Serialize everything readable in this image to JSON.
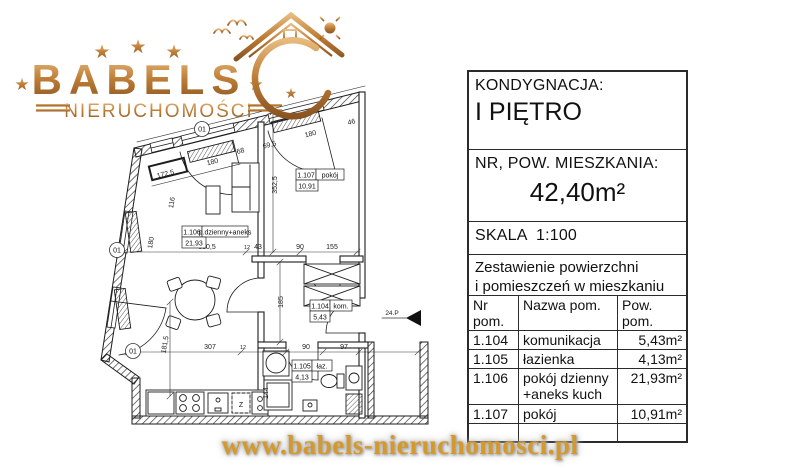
{
  "logo": {
    "brand": "BABELS",
    "subtitle": "NIERUCHOMOŚCI",
    "star": "★",
    "copper": "#b5762f"
  },
  "panel": {
    "floor_label": "KONDYGNACJA:",
    "floor_value": "I PIĘTRO",
    "area_label": "NR, POW. MIESZKANIA:",
    "area_value": "42,40m²",
    "scale_label": "SKALA  1:100",
    "table_title_line1": "Zestawienie powierzchni",
    "table_title_line2": "i pomieszczeń w mieszkaniu",
    "table": {
      "headers": [
        "Nr pom.",
        "Nazwa pom.",
        "Pow. pom."
      ],
      "rows": [
        {
          "nr": "1.104",
          "name": "komunikacja",
          "area": "5,43m²"
        },
        {
          "nr": "1.105",
          "name": "łazienka",
          "area": "4,13m²"
        },
        {
          "nr": "1.106",
          "name": "pokój dzienny +aneks kuch",
          "area": "21,93m²"
        },
        {
          "nr": "1.107",
          "name": "pokój",
          "area": "10,91m²"
        }
      ]
    }
  },
  "plan": {
    "rooms": [
      {
        "id": "1.106",
        "name": "p.dzienny+aneks",
        "area": "21,93"
      },
      {
        "id": "1.107",
        "name": "pokój",
        "area": "10,91"
      },
      {
        "id": "1.104",
        "name": "kom.",
        "area": "5,43"
      },
      {
        "id": "1.105",
        "name": "łaz.",
        "area": "4,13"
      }
    ],
    "dims": {
      "top_wall_a": "172,5",
      "top_window_living": "180",
      "top_seg_68": "68",
      "top_seg_69_5": "69,5",
      "top_window_pokoj": "180",
      "top_seg_46": "46",
      "left_seg_116": "116",
      "pokoj_depth": "352,5",
      "left_window_180": "180",
      "living_width": "330,5",
      "wall_12_a": "12",
      "niche_43": "43",
      "door_90": "90",
      "wardrobe_155": "155",
      "corridor_185": "185",
      "living_height": "181,5",
      "kitchen_307": "307",
      "wall_12_b": "12",
      "bath_door_90": "90",
      "shaft_97": "97",
      "shower_144": "144"
    },
    "markers": {
      "window": "01",
      "entrance": "24.P",
      "dishwasher": "Z"
    }
  },
  "footer": {
    "website": "www.babels-nieruchomosci.pl"
  }
}
